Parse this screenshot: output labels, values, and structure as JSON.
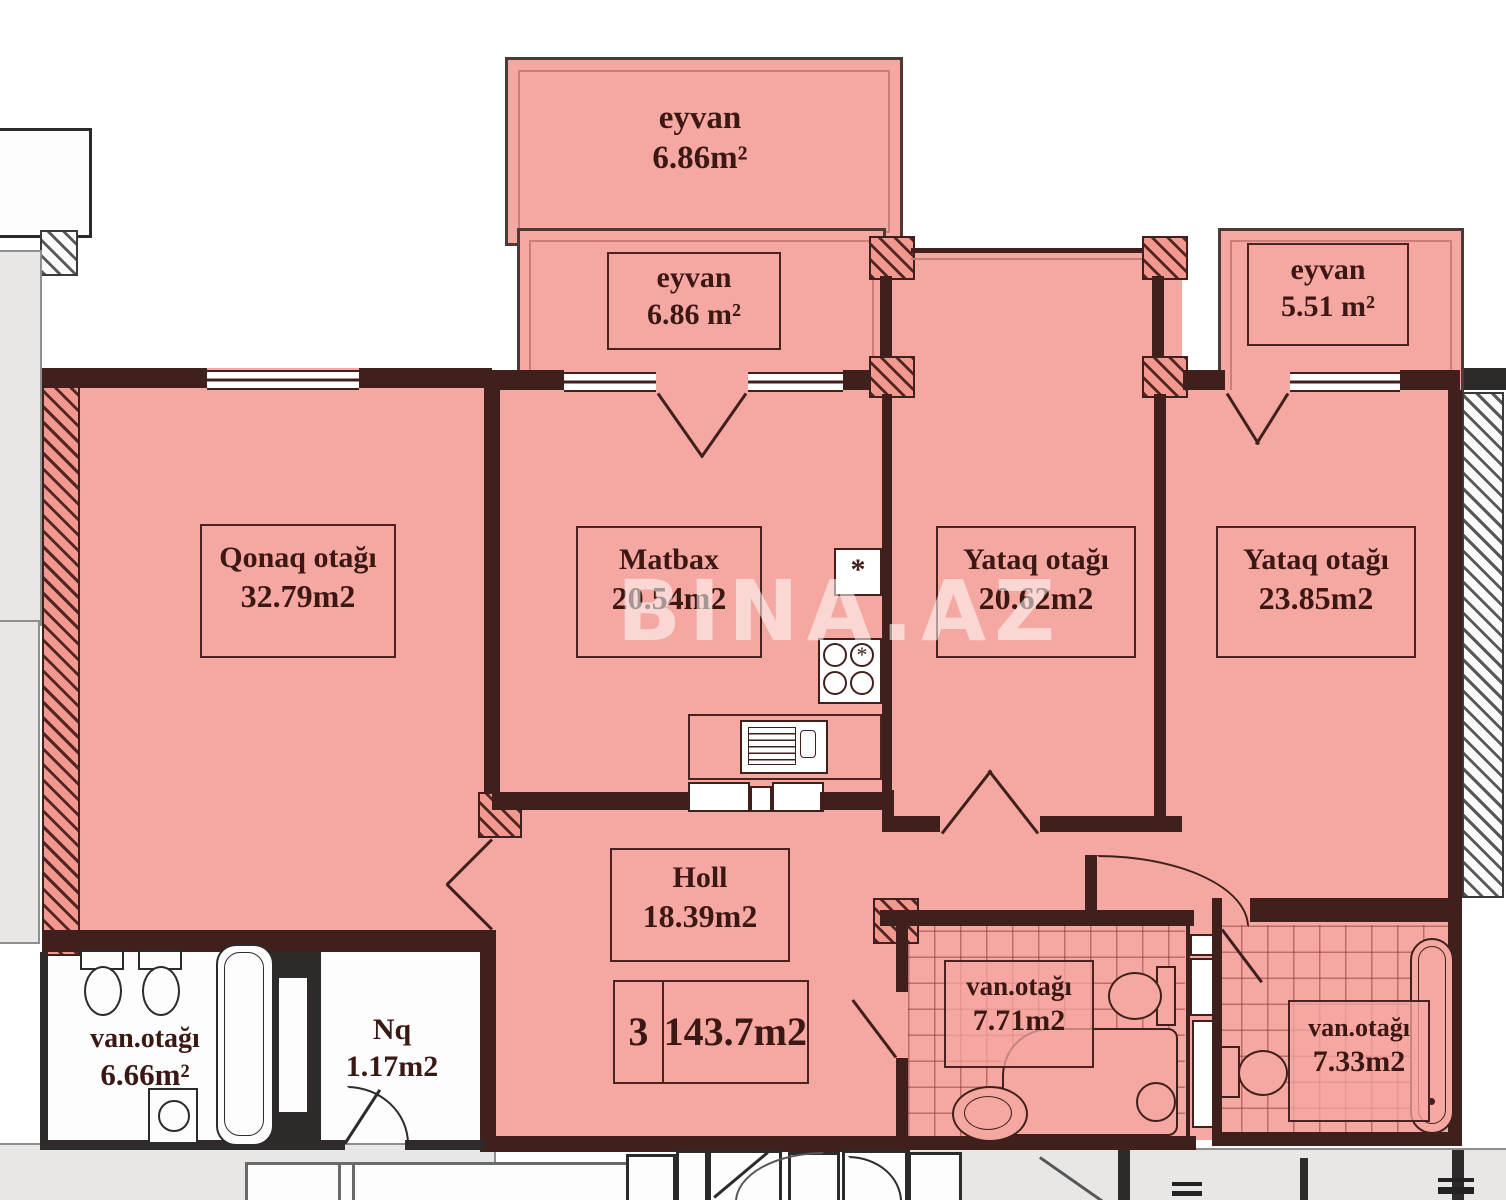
{
  "watermark": "BINA.AZ",
  "rooms": {
    "balcony_top": {
      "name": "eyvan",
      "area": "6.86m²"
    },
    "balcony_mid": {
      "name": "eyvan",
      "area": "6.86 m²"
    },
    "balcony_right": {
      "name": "eyvan",
      "area": "5.51 m²"
    },
    "living": {
      "name": "Qonaq otağı",
      "area": "32.79m2"
    },
    "kitchen": {
      "name": "Matbax",
      "area": "20.54m2"
    },
    "bedroom1": {
      "name": "Yataq otağı",
      "area": "20.62m2"
    },
    "bedroom2": {
      "name": "Yataq otağı",
      "area": "23.85m2"
    },
    "hall": {
      "name": "Holl",
      "area": "18.39m2"
    },
    "bath1": {
      "name": "van.otağı",
      "area": "7.71m2"
    },
    "bath2": {
      "name": "van.otağı",
      "area": "7.33m2"
    },
    "bath_left": {
      "name": "van.otağı",
      "area": "6.66m²"
    },
    "nq": {
      "name": "Nq",
      "area": "1.17m2"
    }
  },
  "summary": {
    "room_count": "3",
    "total_area": "143.7m2"
  },
  "symbols": {
    "stove_mark": "*",
    "vent_mark": "*"
  },
  "colors": {
    "highlight": "#f5a7a1",
    "wall": "#40201c",
    "label_text": "#3c1815"
  }
}
